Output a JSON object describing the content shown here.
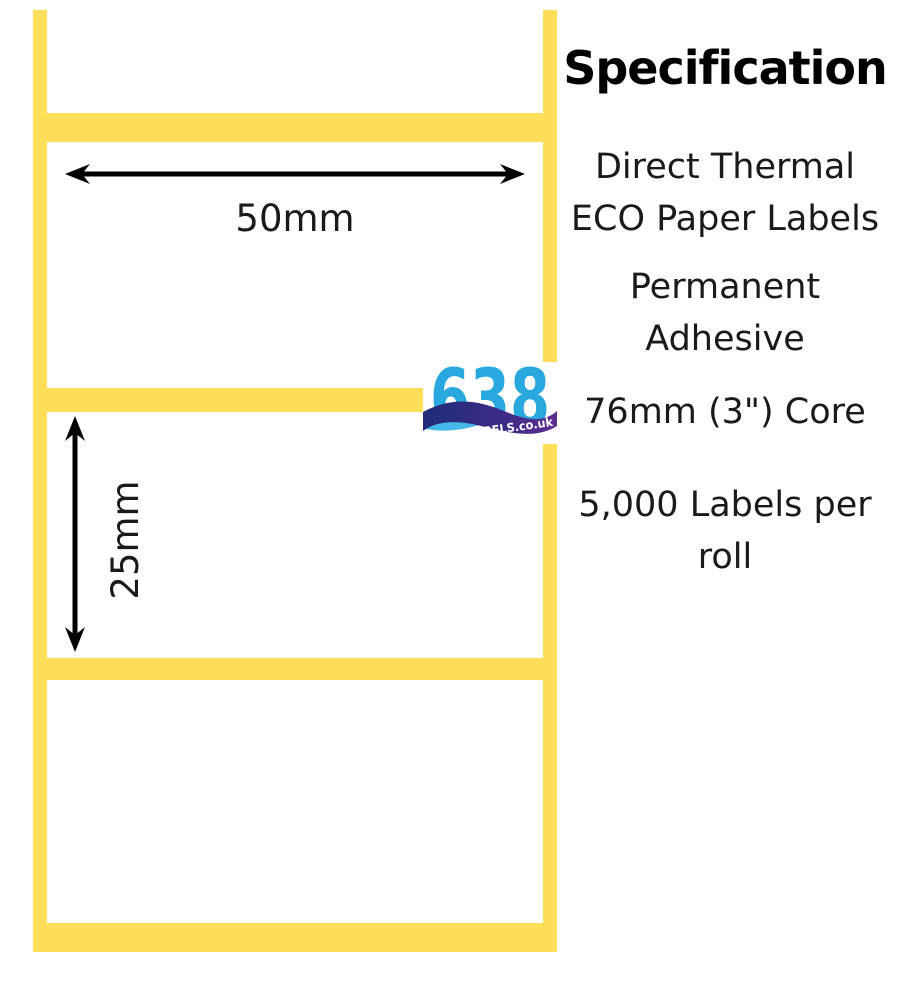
{
  "colors": {
    "yellow": "#FFDE59",
    "text": "#1A1A1A",
    "heading": "#000000",
    "arrow": "#000000",
    "logo_blue": "#29A8E0",
    "logo_navy": "#1F2C77",
    "logo_purple": "#5B2D8F",
    "logo_lightblue": "#45B7E8"
  },
  "diagram": {
    "width_label": "50mm",
    "height_label": "25mm"
  },
  "logo": {
    "number": "638",
    "wordmark": "LABELS.co.uk"
  },
  "spec": {
    "title": "Specification",
    "items": {
      "material": "Direct Thermal ECO Paper Labels",
      "adhesive": "Permanent Adhesive",
      "core": "76mm (3\") Core",
      "quantity": "5,000 Labels per roll"
    }
  }
}
